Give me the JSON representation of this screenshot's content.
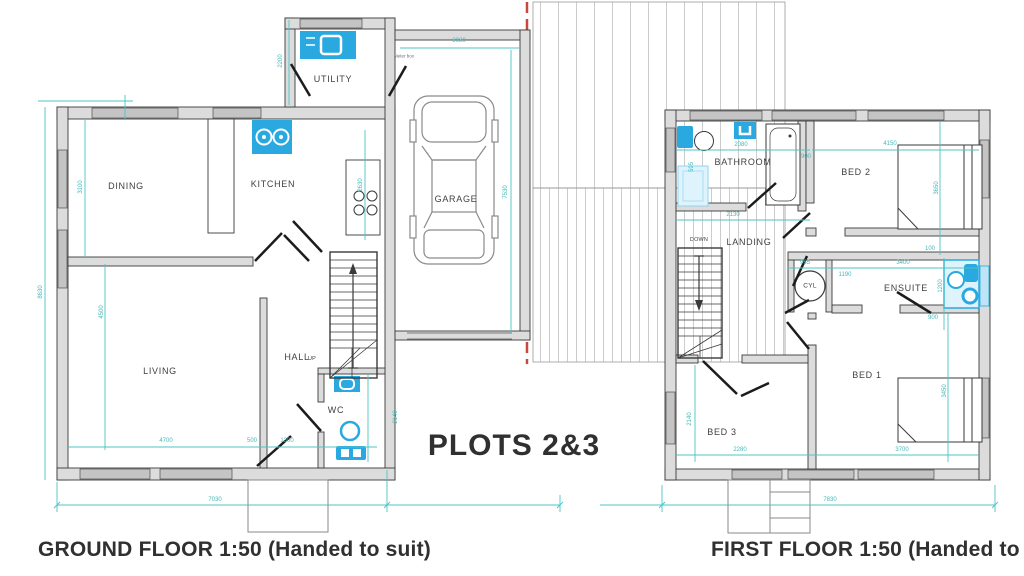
{
  "titles": {
    "plots": "PLOTS 2&3",
    "ground_caption": "GROUND FLOOR  1:50 (Handed to suit)",
    "first_caption": "FIRST FLOOR  1:50 (Handed to suit)"
  },
  "colors": {
    "dimension_teal": "#45b8ba",
    "fixture_blue": "#29a9e0",
    "fixture_light": "#dff3fc",
    "wall_line": "#3a3a3a",
    "wall_fill": "#dcdcdc",
    "window_fill": "#c4c4c4",
    "boundary_red": "#c5493d",
    "hatch_gray": "#9a9a9a",
    "text": "#414141"
  },
  "ground_floor": {
    "rooms": {
      "utility": "UTILITY",
      "dining": "DINING",
      "kitchen": "KITCHEN",
      "garage": "GARAGE",
      "living": "LIVING",
      "hall": "HALL",
      "wc": "WC"
    },
    "stair_direction": "UP",
    "meter_note": "Meter box",
    "dims": {
      "garage_width": "3080",
      "garage_depth": "7530",
      "utility_depth": "2200",
      "dining_depth": "3100",
      "overall_depth": "8630",
      "living_depth": "4500",
      "kitchen_units": "2630",
      "living_width": "4700",
      "hall_step": "500",
      "hall_width": "1300",
      "wc_depth": "2140",
      "overall_width": "7030"
    }
  },
  "first_floor": {
    "rooms": {
      "bathroom": "BATHROOM",
      "bed2": "BED 2",
      "landing": "LANDING",
      "cyl": "CYL",
      "ensuite": "ENSUITE",
      "bed1": "BED 1",
      "bed3": "BED 3"
    },
    "stair_direction": "DOWN",
    "dims": {
      "bathroom_width": "2080",
      "bathroom_offset": "900",
      "bathroom_left": "595",
      "bathroom_lower": "2130",
      "bed2_width": "4150",
      "bed2_depth": "3650",
      "bed2_gap": "100",
      "cyl_width": "965",
      "ensuite_width": "3400",
      "ensuite_inner": "1190",
      "ensuite_depth": "1200",
      "ensuite_offset": "900",
      "bed3_depth": "2140",
      "bed3_width": "2280",
      "bed1_width": "3700",
      "bed1_depth": "3450",
      "overall_width": "7830"
    }
  }
}
